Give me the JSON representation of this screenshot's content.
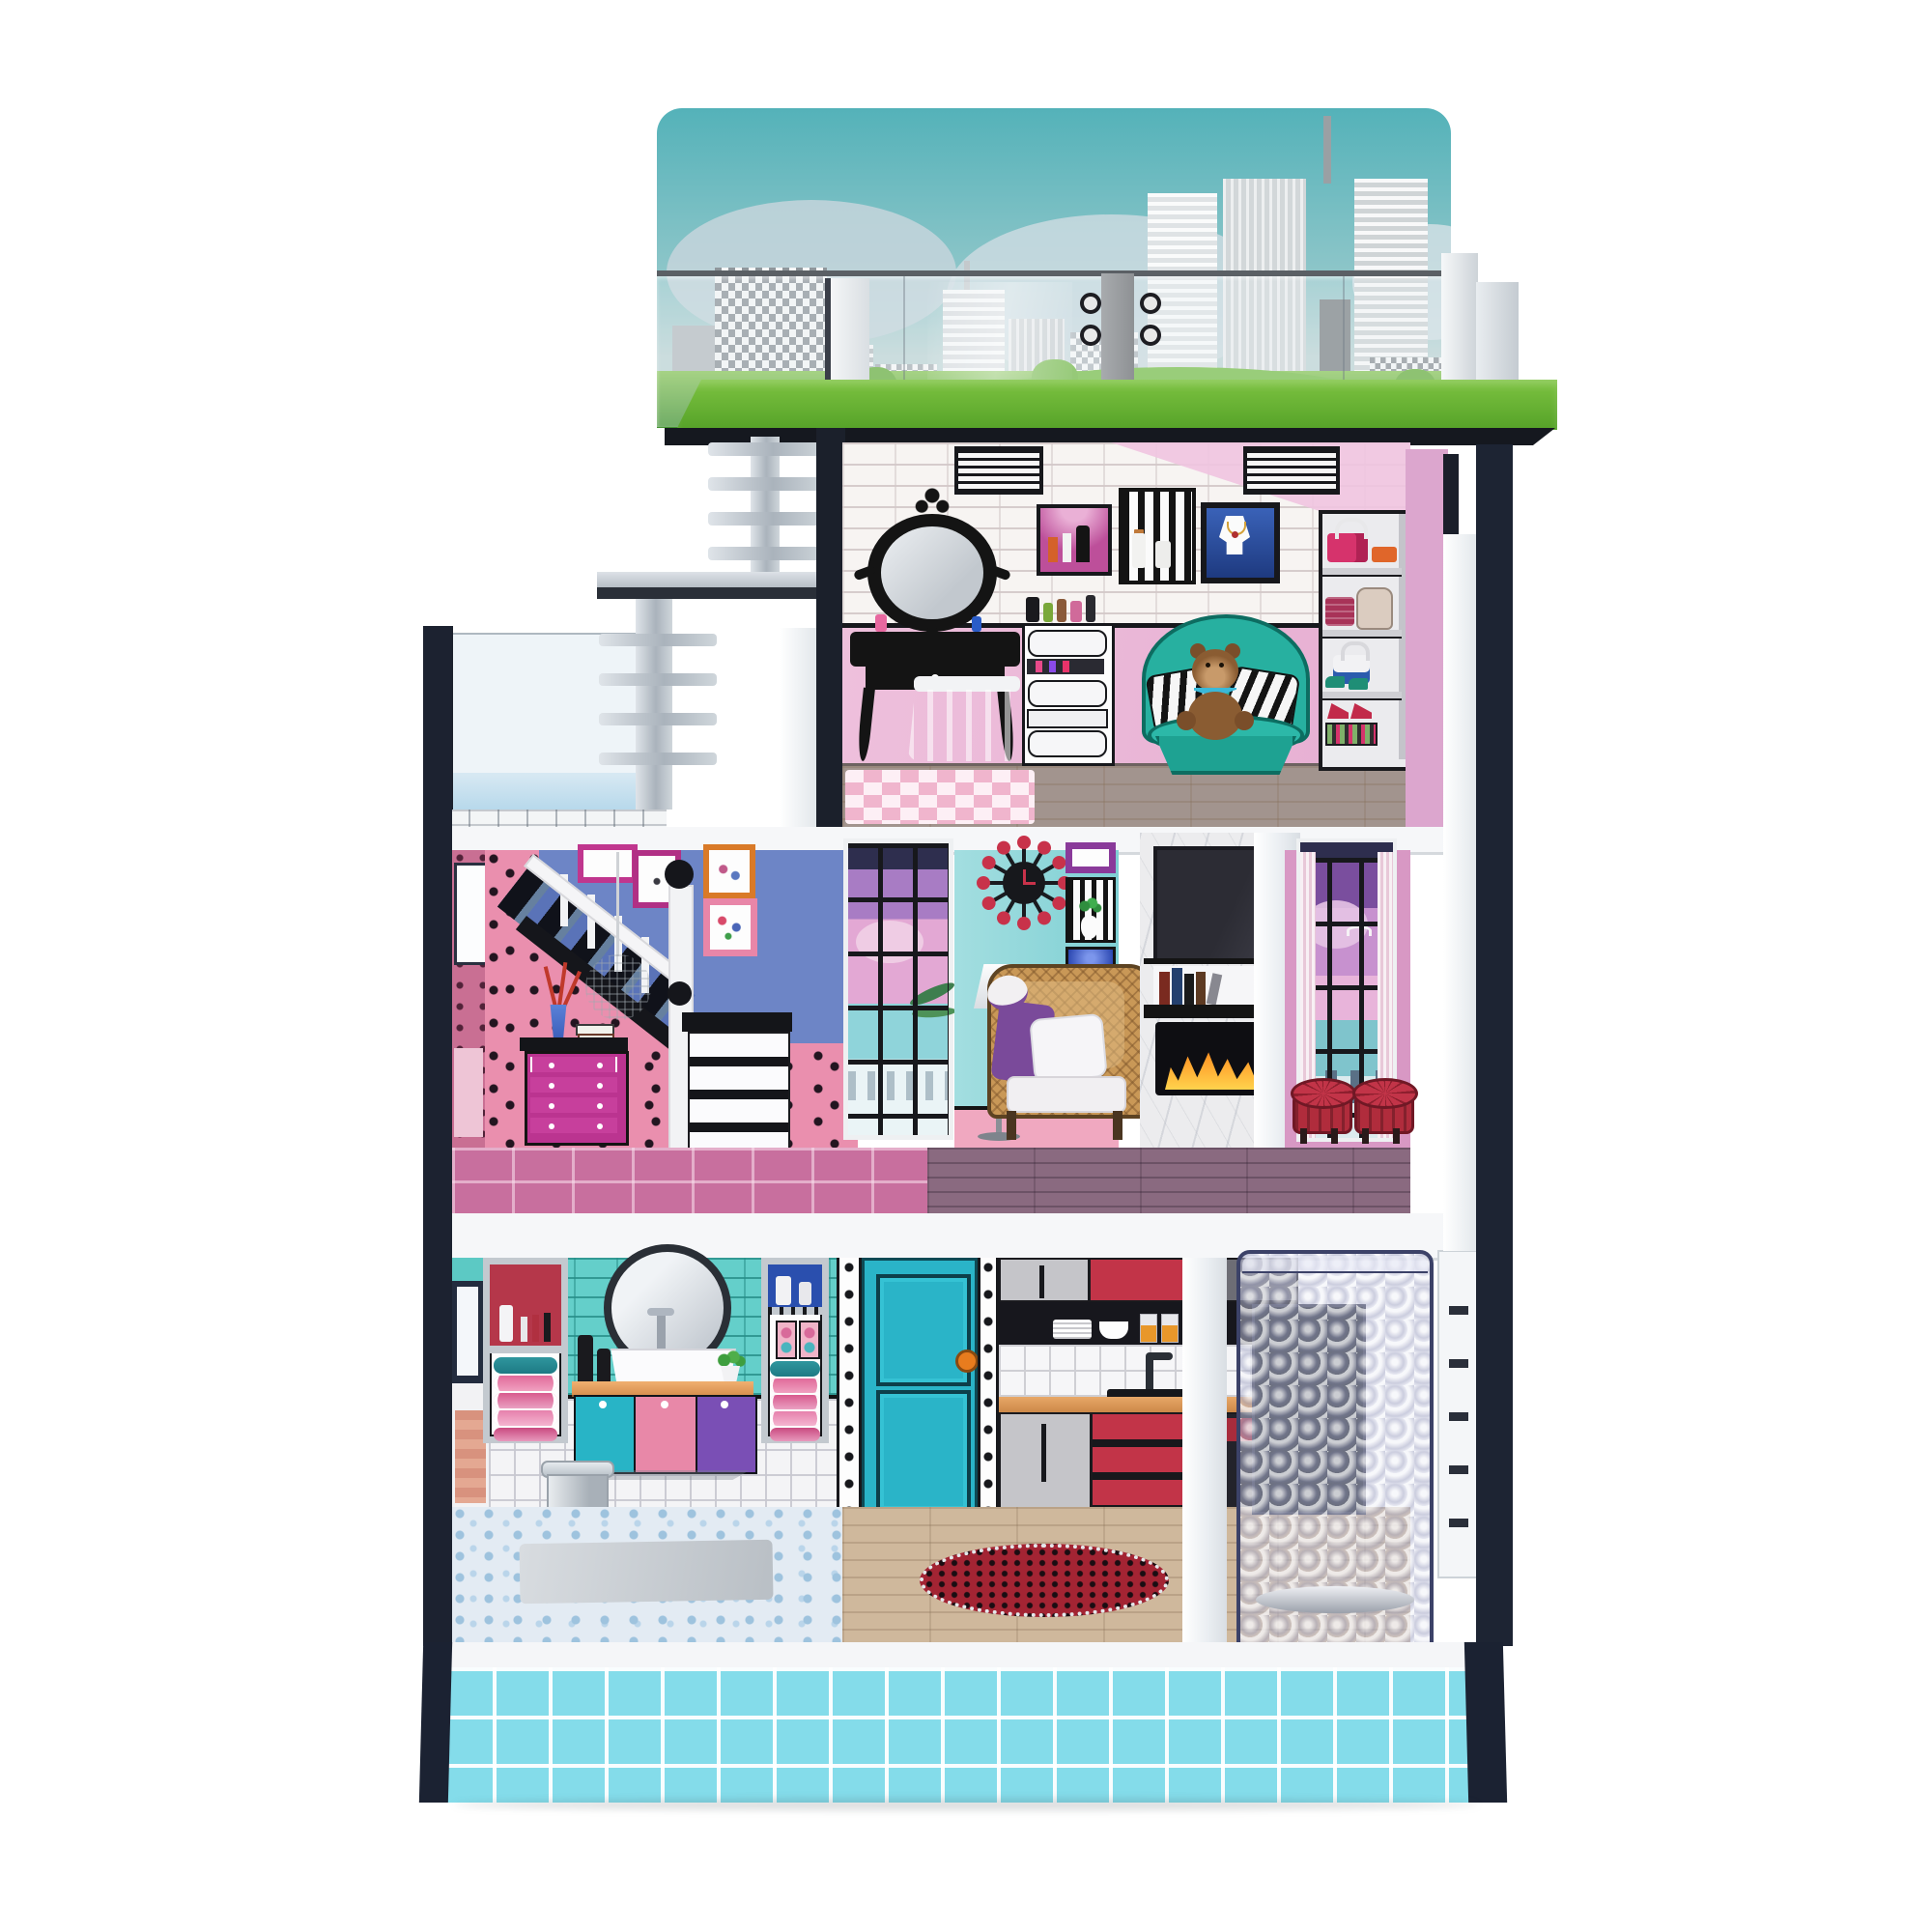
{
  "image_type": "product photograph",
  "subject": "three-story toy dollhouse with rooftop terrace, open front, and side elevator, on plain white background",
  "background_color": "#ffffff",
  "palette": {
    "frame_black": "#1b2030",
    "slab_white": "#f6f7f9",
    "grass_green": "#5fae2f",
    "sky_teal": "#5ab3ba",
    "wall_pink": "#eec0dc",
    "wallpaper_pink": "#ea8fae",
    "wall_blue": "#6d85c6",
    "wall_teal": "#8fd6d8",
    "magenta": "#c0368e",
    "chair_teal": "#27b0a0",
    "kitchen_red": "#c23448",
    "door_teal": "#2ab4c8",
    "base_cyan": "#84dcea",
    "elevator_tint": "#cdd0e4"
  },
  "rooftop_terrace": {
    "backdrop": "printed city skyline board with teal sky, grey high-rise buildings, clouds, green trees and lawn hills",
    "railing": "clear acrylic panels with white corner posts and grey hinged gate",
    "floor": "green felt lawn with black fascia edge"
  },
  "left_structures": {
    "items": [
      "silver ladder",
      "small silver landing platform",
      "second silver ladder",
      "acrylic-walled deck with white grid floor and black corner frame"
    ]
  },
  "third_floor_dressing_room": {
    "walls": "white brick upper band over pink, black dado line, two black-and-white ceiling vents",
    "items": [
      "ornate black vanity mirror",
      "black vanity table with drawer",
      "blue tulle stool",
      "pink and white checkered rug",
      "white cosmetics chest with bottles on top",
      "pink perfume niche",
      "striped perfume niche",
      "blue framed necklace picture",
      "teal tub chair",
      "two zebra print pillows",
      "brown teddy bear with blue polka-dot bow",
      "grey cube shelf with pink handbag, orange clutch, beige backpack, maroon purse, blue handbag, teal sneakers, red heels and striped shoebox"
    ],
    "floor": "grey wood planks"
  },
  "second_floor_living_room": {
    "walls": "pink triangle-confetti wallpaper, periwinkle gallery wall with four framed pictures, light teal wall with pink dado",
    "items": [
      "white staircase railing with black ball newels and black stringer",
      "grey cabinet with black top",
      "magenta four-drawer dresser",
      "blue vase with red coral branches",
      "stack of books",
      "white disco-ball pendant lamp",
      "tall window with ocean view and palm leaves",
      "red starburst wall clock",
      "white floor lamp",
      "wall niche with plant",
      "blue LED niche",
      "rattan tub armchair with white cushion, pillow, purple throw and sun hat",
      "white marble fireplace column with TV, bookshelf and lit firebox",
      "two red tufted stools",
      "curtained tall window"
    ],
    "floor": "pink tile on the left, purple wood planks with spiral rug on the right"
  },
  "ground_floor": {
    "bathroom": [
      "teal subway tile wall",
      "white tile lower wall",
      "round mirror",
      "black cosmetic bottles",
      "white sink with silver faucet",
      "vanity with teal, pink and purple doors",
      "green plant",
      "silver trash can",
      "two niches with rolled striped towels and toiletries",
      "blue pebble mosaic floor with grey mat"
    ],
    "hallway": [
      "teal paneled door with orange knob",
      "white dotted trim strips"
    ],
    "kitchen": [
      "grey and red upper cabinets",
      "black open shelf with white plates, bowls and orange juice glasses",
      "white tile backsplash",
      "wood countertop with black sink and faucet",
      "grey and red lower cabinets",
      "black appliance",
      "light wood plank floor",
      "red dotted round rug"
    ],
    "elevator": "clear quatrefoil-textured plastic shaft with navy edges and white slotted side rail",
    "posts": "white structural front posts"
  },
  "base": {
    "style": "cyan tile platform with white grout lines, white top edge, dark navy corner posts"
  }
}
